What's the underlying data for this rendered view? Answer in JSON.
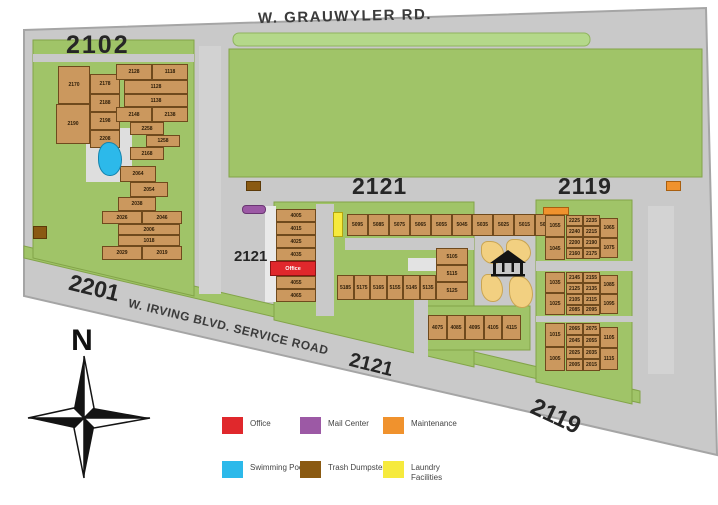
{
  "streets": {
    "grauwyler": "W. GRAUWYLER RD."
  },
  "blocks": {
    "b2102": "2102"
  },
  "roads": {
    "r2121": "2121",
    "r2119": "2119"
  },
  "parking": {
    "p2121": "2121"
  },
  "diagonal": {
    "addr2201": "2201",
    "name": "W. IRVING BLVD. SERVICE ROAD",
    "addr2121": "2121",
    "addr2119": "2119"
  },
  "compass": {
    "label": "N"
  },
  "legend": {
    "items": [
      {
        "label": "Office",
        "color": "#e0282c"
      },
      {
        "label": "Mail Center",
        "color": "#9c59a5"
      },
      {
        "label": "Maintenance",
        "color": "#f0922d"
      },
      {
        "label": "Swimming Pool",
        "color": "#2cb9ea"
      },
      {
        "label": "Trash Dumpster",
        "color": "#8a5a12"
      },
      {
        "label": "Laundry Facilities",
        "color": "#f6ea3d"
      }
    ]
  },
  "colors": {
    "map_base": "#c9c9c9",
    "green": "#a0c468",
    "green_strip": "#b4d88a",
    "building": "#cb985e"
  },
  "map": {
    "groups": [
      {
        "name": "bldg-2102-west",
        "cells": [
          {
            "x": 58,
            "y": 66,
            "w": 32,
            "h": 38,
            "label": "2170"
          },
          {
            "x": 90,
            "y": 74,
            "w": 30,
            "h": 20,
            "label": "2178"
          },
          {
            "x": 90,
            "y": 94,
            "w": 30,
            "h": 18,
            "label": "2188"
          },
          {
            "x": 56,
            "y": 104,
            "w": 34,
            "h": 40,
            "label": "2190"
          },
          {
            "x": 90,
            "y": 112,
            "w": 30,
            "h": 18,
            "label": "2198"
          },
          {
            "x": 90,
            "y": 130,
            "w": 30,
            "h": 18,
            "label": "2208"
          }
        ]
      },
      {
        "name": "bldg-2102-east",
        "cells": [
          {
            "x": 116,
            "y": 64,
            "w": 36,
            "h": 16,
            "label": "2128"
          },
          {
            "x": 152,
            "y": 64,
            "w": 36,
            "h": 16,
            "label": "1118"
          },
          {
            "x": 124,
            "y": 80,
            "w": 64,
            "h": 14,
            "label": "1128"
          },
          {
            "x": 124,
            "y": 94,
            "w": 64,
            "h": 13,
            "label": "1138"
          },
          {
            "x": 116,
            "y": 107,
            "w": 36,
            "h": 15,
            "label": "2148"
          },
          {
            "x": 152,
            "y": 107,
            "w": 36,
            "h": 15,
            "label": "2138"
          },
          {
            "x": 130,
            "y": 122,
            "w": 34,
            "h": 13,
            "label": "2258"
          },
          {
            "x": 146,
            "y": 135,
            "w": 34,
            "h": 12,
            "label": "1258"
          },
          {
            "x": 130,
            "y": 147,
            "w": 34,
            "h": 13,
            "label": "2168"
          }
        ]
      },
      {
        "name": "bldg-2102-south",
        "cells": [
          {
            "x": 120,
            "y": 166,
            "w": 36,
            "h": 16,
            "label": "2064"
          },
          {
            "x": 130,
            "y": 182,
            "w": 38,
            "h": 15,
            "label": "2054"
          },
          {
            "x": 118,
            "y": 197,
            "w": 38,
            "h": 14,
            "label": "2038"
          },
          {
            "x": 102,
            "y": 211,
            "w": 40,
            "h": 13,
            "label": "2026"
          },
          {
            "x": 142,
            "y": 211,
            "w": 40,
            "h": 13,
            "label": "2046"
          },
          {
            "x": 118,
            "y": 224,
            "w": 62,
            "h": 11,
            "label": "2006"
          },
          {
            "x": 118,
            "y": 235,
            "w": 62,
            "h": 11,
            "label": "1018"
          },
          {
            "x": 102,
            "y": 246,
            "w": 40,
            "h": 14,
            "label": "2029"
          },
          {
            "x": 142,
            "y": 246,
            "w": 40,
            "h": 14,
            "label": "2019"
          }
        ]
      },
      {
        "name": "bldg-2121-office-col",
        "cells": [
          {
            "x": 276,
            "y": 209,
            "w": 40,
            "h": 13,
            "label": "4005"
          },
          {
            "x": 276,
            "y": 222,
            "w": 40,
            "h": 13,
            "label": "4015"
          },
          {
            "x": 276,
            "y": 235,
            "w": 40,
            "h": 13,
            "label": "4025"
          },
          {
            "x": 276,
            "y": 248,
            "w": 40,
            "h": 13,
            "label": "4035"
          },
          {
            "x": 270,
            "y": 261,
            "w": 46,
            "h": 15,
            "label": "Office",
            "cls": "office",
            "name": "office"
          },
          {
            "x": 276,
            "y": 276,
            "w": 40,
            "h": 13,
            "label": "4055"
          },
          {
            "x": 276,
            "y": 289,
            "w": 40,
            "h": 13,
            "label": "4065"
          }
        ]
      },
      {
        "name": "bldg-2121-top-row",
        "cells": [
          {
            "x": 347,
            "y": 214,
            "w": 21,
            "h": 22,
            "label": "5095"
          },
          {
            "x": 368,
            "y": 214,
            "w": 21,
            "h": 22,
            "label": "5085"
          },
          {
            "x": 389,
            "y": 214,
            "w": 21,
            "h": 22,
            "label": "5075"
          },
          {
            "x": 410,
            "y": 214,
            "w": 21,
            "h": 22,
            "label": "5065"
          },
          {
            "x": 431,
            "y": 214,
            "w": 21,
            "h": 22,
            "label": "5055"
          },
          {
            "x": 452,
            "y": 214,
            "w": 20,
            "h": 22,
            "label": "5045"
          },
          {
            "x": 472,
            "y": 214,
            "w": 21,
            "h": 22,
            "label": "5035"
          },
          {
            "x": 493,
            "y": 214,
            "w": 21,
            "h": 22,
            "label": "5025"
          },
          {
            "x": 514,
            "y": 214,
            "w": 21,
            "h": 22,
            "label": "5015"
          },
          {
            "x": 535,
            "y": 214,
            "w": 21,
            "h": 22,
            "label": "5005"
          }
        ]
      },
      {
        "name": "bldg-2121-mid-row",
        "cells": [
          {
            "x": 337,
            "y": 275,
            "w": 17,
            "h": 25,
            "label": "5185"
          },
          {
            "x": 354,
            "y": 275,
            "w": 16,
            "h": 25,
            "label": "5175"
          },
          {
            "x": 370,
            "y": 275,
            "w": 17,
            "h": 25,
            "label": "5165"
          },
          {
            "x": 387,
            "y": 275,
            "w": 16,
            "h": 25,
            "label": "5155"
          },
          {
            "x": 403,
            "y": 275,
            "w": 17,
            "h": 25,
            "label": "5145"
          },
          {
            "x": 420,
            "y": 275,
            "w": 16,
            "h": 25,
            "label": "5135"
          },
          {
            "x": 436,
            "y": 248,
            "w": 32,
            "h": 17,
            "label": "5105"
          },
          {
            "x": 436,
            "y": 265,
            "w": 32,
            "h": 17,
            "label": "5115"
          },
          {
            "x": 436,
            "y": 282,
            "w": 32,
            "h": 18,
            "label": "5125"
          }
        ]
      },
      {
        "name": "bldg-2121-south-row",
        "cells": [
          {
            "x": 428,
            "y": 315,
            "w": 19,
            "h": 25,
            "label": "4075"
          },
          {
            "x": 447,
            "y": 315,
            "w": 18,
            "h": 25,
            "label": "4085"
          },
          {
            "x": 465,
            "y": 315,
            "w": 19,
            "h": 25,
            "label": "4095"
          },
          {
            "x": 484,
            "y": 315,
            "w": 18,
            "h": 25,
            "label": "4105"
          },
          {
            "x": 502,
            "y": 315,
            "w": 19,
            "h": 25,
            "label": "4115"
          }
        ]
      },
      {
        "name": "bldg-2119-north",
        "cells": [
          {
            "x": 545,
            "y": 215,
            "w": 20,
            "h": 22,
            "label": "1055"
          },
          {
            "x": 545,
            "y": 237,
            "w": 20,
            "h": 23,
            "label": "1045"
          },
          {
            "x": 566,
            "y": 215,
            "w": 17,
            "h": 11,
            "label": "2225"
          },
          {
            "x": 583,
            "y": 215,
            "w": 17,
            "h": 11,
            "label": "2235"
          },
          {
            "x": 566,
            "y": 226,
            "w": 17,
            "h": 11,
            "label": "2240"
          },
          {
            "x": 583,
            "y": 226,
            "w": 17,
            "h": 11,
            "label": "2215"
          },
          {
            "x": 566,
            "y": 237,
            "w": 17,
            "h": 11,
            "label": "2200"
          },
          {
            "x": 583,
            "y": 237,
            "w": 17,
            "h": 11,
            "label": "2190"
          },
          {
            "x": 566,
            "y": 248,
            "w": 17,
            "h": 11,
            "label": "2160"
          },
          {
            "x": 583,
            "y": 248,
            "w": 17,
            "h": 11,
            "label": "2175"
          },
          {
            "x": 600,
            "y": 218,
            "w": 18,
            "h": 20,
            "label": "1065"
          },
          {
            "x": 600,
            "y": 238,
            "w": 18,
            "h": 20,
            "label": "1075"
          }
        ]
      },
      {
        "name": "bldg-2119-mid",
        "cells": [
          {
            "x": 545,
            "y": 272,
            "w": 20,
            "h": 21,
            "label": "1035"
          },
          {
            "x": 545,
            "y": 293,
            "w": 20,
            "h": 22,
            "label": "1025"
          },
          {
            "x": 566,
            "y": 272,
            "w": 17,
            "h": 11,
            "label": "2145"
          },
          {
            "x": 583,
            "y": 272,
            "w": 17,
            "h": 11,
            "label": "2155"
          },
          {
            "x": 566,
            "y": 283,
            "w": 17,
            "h": 11,
            "label": "2125"
          },
          {
            "x": 583,
            "y": 283,
            "w": 17,
            "h": 11,
            "label": "2135"
          },
          {
            "x": 566,
            "y": 294,
            "w": 17,
            "h": 11,
            "label": "2105"
          },
          {
            "x": 583,
            "y": 294,
            "w": 17,
            "h": 11,
            "label": "2115"
          },
          {
            "x": 566,
            "y": 305,
            "w": 17,
            "h": 10,
            "label": "2085"
          },
          {
            "x": 583,
            "y": 305,
            "w": 17,
            "h": 10,
            "label": "2095"
          },
          {
            "x": 600,
            "y": 275,
            "w": 18,
            "h": 19,
            "label": "1085"
          },
          {
            "x": 600,
            "y": 294,
            "w": 18,
            "h": 20,
            "label": "1095"
          }
        ]
      },
      {
        "name": "bldg-2119-south",
        "cells": [
          {
            "x": 545,
            "y": 323,
            "w": 20,
            "h": 24,
            "label": "1015"
          },
          {
            "x": 545,
            "y": 347,
            "w": 20,
            "h": 24,
            "label": "1005"
          },
          {
            "x": 566,
            "y": 323,
            "w": 17,
            "h": 12,
            "label": "2065"
          },
          {
            "x": 583,
            "y": 323,
            "w": 17,
            "h": 12,
            "label": "2075"
          },
          {
            "x": 566,
            "y": 335,
            "w": 17,
            "h": 12,
            "label": "2045"
          },
          {
            "x": 583,
            "y": 335,
            "w": 17,
            "h": 12,
            "label": "2055"
          },
          {
            "x": 566,
            "y": 347,
            "w": 17,
            "h": 12,
            "label": "2025"
          },
          {
            "x": 583,
            "y": 347,
            "w": 17,
            "h": 12,
            "label": "2035"
          },
          {
            "x": 566,
            "y": 359,
            "w": 17,
            "h": 12,
            "label": "2005"
          },
          {
            "x": 583,
            "y": 359,
            "w": 17,
            "h": 12,
            "label": "2015"
          },
          {
            "x": 600,
            "y": 327,
            "w": 18,
            "h": 21,
            "label": "1105"
          },
          {
            "x": 600,
            "y": 348,
            "w": 18,
            "h": 22,
            "label": "1115"
          }
        ]
      },
      {
        "name": "features",
        "cells": [
          {
            "x": 98,
            "y": 142,
            "w": 24,
            "h": 34,
            "cls": "pool",
            "name": "swimming-pool"
          },
          {
            "x": 333,
            "y": 212,
            "w": 10,
            "h": 25,
            "cls": "laundry",
            "name": "laundry-facility"
          },
          {
            "x": 242,
            "y": 205,
            "w": 24,
            "h": 9,
            "cls": "mail",
            "name": "mail-center"
          },
          {
            "x": 33,
            "y": 226,
            "w": 14,
            "h": 13,
            "cls": "dumpster",
            "name": "trash-dumpster"
          },
          {
            "x": 246,
            "y": 181,
            "w": 15,
            "h": 10,
            "cls": "dumpster",
            "name": "trash-dumpster"
          },
          {
            "x": 666,
            "y": 181,
            "w": 15,
            "h": 10,
            "cls": "maint",
            "name": "maintenance-shed"
          },
          {
            "x": 543,
            "y": 207,
            "w": 26,
            "h": 8,
            "cls": "maint",
            "name": "maintenance-shed"
          },
          {
            "x": 481,
            "y": 241,
            "w": 23,
            "h": 23,
            "cls": "amenity",
            "name": "amenity-area"
          },
          {
            "x": 506,
            "y": 239,
            "w": 25,
            "h": 24,
            "cls": "amenity",
            "name": "amenity-area"
          },
          {
            "x": 481,
            "y": 274,
            "w": 22,
            "h": 28,
            "cls": "amenity",
            "name": "amenity-area"
          },
          {
            "x": 509,
            "y": 276,
            "w": 24,
            "h": 32,
            "cls": "amenity",
            "name": "amenity-area"
          }
        ]
      }
    ]
  }
}
